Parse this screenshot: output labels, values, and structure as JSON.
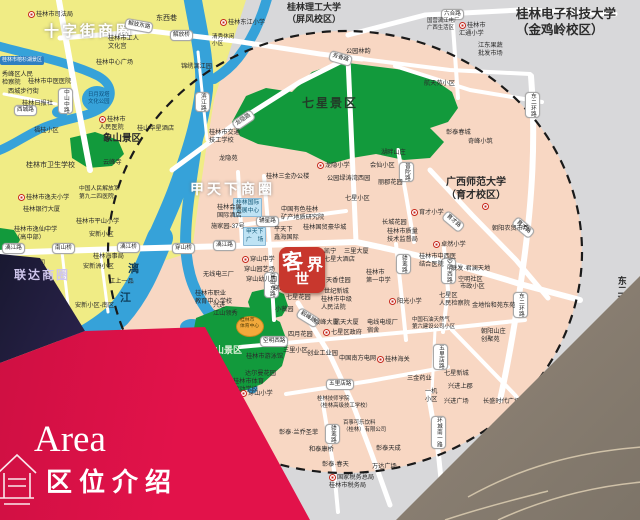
{
  "banner": {
    "area_en": "Area",
    "area_zh": "区位介绍"
  },
  "logo": {
    "c1": "客",
    "c2": "世",
    "c3": "界"
  },
  "photo_overlay_text": "联达商圈",
  "colors": {
    "background_gray": "#d8d8da",
    "district_salmon": "#f8d7c3",
    "downtown_yellow": "#f0ec85",
    "park_green": "#129a3c",
    "river_blue": "#36a2d9",
    "road_white": "#ffffff",
    "banner_red": "#e2124a",
    "logo_red": "#c8372d",
    "dashed_ring": "#1a1a1a"
  },
  "map": {
    "labels": [
      {
        "t": "十字街商圈",
        "x": 44,
        "y": 22,
        "k": "big",
        "fs": 15
      },
      {
        "t": "甲天下商圈",
        "x": 190,
        "y": 180,
        "k": "big",
        "fs": 14
      },
      {
        "t": "七星景区",
        "x": 302,
        "y": 96,
        "fs": 12,
        "b": 1,
        "c": "#223b28",
        "ls": 2
      },
      {
        "t": "穿山景区",
        "x": 206,
        "y": 345,
        "fs": 9,
        "b": 1,
        "c": "#dff0da"
      },
      {
        "t": "象山景区",
        "x": 103,
        "y": 133,
        "fs": 9.5,
        "b": 1
      },
      {
        "t": "漓",
        "x": 128,
        "y": 262,
        "fs": 11,
        "b": 1,
        "c": "#0f3f5c"
      },
      {
        "t": "江",
        "x": 120,
        "y": 291,
        "fs": 11,
        "b": 1,
        "c": "#0f3f5c"
      },
      {
        "t": "桂林电子科技大学\n（金鸡岭校区）",
        "x": 516,
        "y": 6,
        "fs": 12.5,
        "b": 1
      },
      {
        "t": "桂林理工大学\n（屏风校区）",
        "x": 287,
        "y": 2,
        "fs": 9,
        "b": 1
      },
      {
        "t": "广西师范大学\n（育才校区）",
        "x": 446,
        "y": 176,
        "fs": 10,
        "b": 1
      },
      {
        "t": "",
        "x": 482,
        "y": 203,
        "m": 1
      },
      {
        "t": "东二环路",
        "x": 615,
        "y": 276,
        "fs": 9,
        "b": 1,
        "v": 1
      },
      {
        "t": "解放东路",
        "x": 126,
        "y": 18,
        "k": "pill",
        "r": 10
      },
      {
        "t": "解放桥",
        "x": 170,
        "y": 30,
        "k": "pill"
      },
      {
        "t": "六合路",
        "x": 441,
        "y": 9,
        "k": "pill"
      },
      {
        "t": "芳香路",
        "x": 331,
        "y": 50,
        "k": "pill",
        "r": 16
      },
      {
        "t": "龙隐路",
        "x": 231,
        "y": 122,
        "k": "pill",
        "r": -34
      },
      {
        "t": "滨江路",
        "x": 195,
        "y": 92,
        "k": "pill",
        "v": 1
      },
      {
        "t": "中山中路",
        "x": 58,
        "y": 88,
        "k": "pill",
        "v": 1
      },
      {
        "t": "西城路",
        "x": 14,
        "y": 105,
        "k": "pill"
      },
      {
        "t": "漓江路",
        "x": 2,
        "y": 243,
        "k": "pill"
      },
      {
        "t": "南山桥",
        "x": 52,
        "y": 243,
        "k": "pill"
      },
      {
        "t": "漓江桥",
        "x": 117,
        "y": 242,
        "k": "pill"
      },
      {
        "t": "穿山桥",
        "x": 172,
        "y": 243,
        "k": "pill"
      },
      {
        "t": "漓江路",
        "x": 213,
        "y": 240,
        "k": "pill"
      },
      {
        "t": "穿山东路",
        "x": 264,
        "y": 272,
        "k": "pill",
        "v": 1
      },
      {
        "t": "辅星路",
        "x": 256,
        "y": 216,
        "k": "pill"
      },
      {
        "t": "普陀路",
        "x": 399,
        "y": 162,
        "k": "pill",
        "v": 1
      },
      {
        "t": "育才路",
        "x": 448,
        "y": 210,
        "k": "pill",
        "r": 40
      },
      {
        "t": "育才路",
        "x": 518,
        "y": 216,
        "k": "pill",
        "r": 40
      },
      {
        "t": "骖鸾路",
        "x": 396,
        "y": 254,
        "k": "pill",
        "v": 1
      },
      {
        "t": "毅峰路",
        "x": 301,
        "y": 307,
        "k": "pill",
        "r": 32
      },
      {
        "t": "空明西路",
        "x": 260,
        "y": 336,
        "k": "pill"
      },
      {
        "t": "空明西路",
        "x": 441,
        "y": 258,
        "k": "pill",
        "v": 1
      },
      {
        "t": "五里店路",
        "x": 326,
        "y": 379,
        "k": "pill"
      },
      {
        "t": "五里店路",
        "x": 433,
        "y": 344,
        "k": "pill",
        "v": 1
      },
      {
        "t": "骖鸾路",
        "x": 325,
        "y": 424,
        "k": "pill",
        "v": 1
      },
      {
        "t": "环城南一路",
        "x": 431,
        "y": 416,
        "k": "pill",
        "v": 1
      },
      {
        "t": "东二环路",
        "x": 525,
        "y": 92,
        "k": "pill",
        "v": 1
      },
      {
        "t": "东二环路",
        "x": 513,
        "y": 292,
        "k": "pill",
        "v": 1
      },
      {
        "t": "湖塘路",
        "x": 550,
        "y": 405,
        "k": "pill",
        "v": 1
      },
      {
        "t": "桂林国际\n会展中心",
        "x": 233,
        "y": 198,
        "k": "blue"
      },
      {
        "t": "甲天下\n广　场",
        "x": 243,
        "y": 227,
        "k": "blue"
      },
      {
        "t": "桂林市榕杉湖景区",
        "x": 0,
        "y": 56,
        "k": "blue2"
      },
      {
        "t": "桂林市司法局",
        "x": 28,
        "y": 11,
        "m": 1
      },
      {
        "t": "东西巷",
        "x": 156,
        "y": 14,
        "fs": 7
      },
      {
        "t": "桂林市工人\n文化宫",
        "x": 108,
        "y": 35
      },
      {
        "t": "桂林中心广场",
        "x": 96,
        "y": 59
      },
      {
        "t": "秀峰区人民\n检察院",
        "x": 2,
        "y": 71
      },
      {
        "t": "桂林市中医医院",
        "x": 28,
        "y": 78
      },
      {
        "t": "西城步行街",
        "x": 8,
        "y": 88
      },
      {
        "t": "桂林日报社",
        "x": 22,
        "y": 100
      },
      {
        "t": "日月双塔\n文化公园",
        "x": 88,
        "y": 92,
        "fs": 5.4,
        "c": "#0d4d7a"
      },
      {
        "t": "桂林市\n人民医院",
        "x": 99,
        "y": 116,
        "m": 1
      },
      {
        "t": "桂林市卫生学校",
        "x": 26,
        "y": 161,
        "fs": 7
      },
      {
        "t": "云峰寺",
        "x": 103,
        "y": 159
      },
      {
        "t": "福桂小区",
        "x": 34,
        "y": 127
      },
      {
        "t": "桂林市逸夫小学",
        "x": 18,
        "y": 194,
        "m": 1
      },
      {
        "t": "桂林银行大厦",
        "x": 23,
        "y": 206
      },
      {
        "t": "桂林市逸仙中学\n（高中部）",
        "x": 14,
        "y": 226
      },
      {
        "t": "中国人民解放军\n第九二四医院",
        "x": 79,
        "y": 186,
        "fs": 5.8
      },
      {
        "t": "桂林市平山小学",
        "x": 76,
        "y": 218
      },
      {
        "t": "安新小区",
        "x": 89,
        "y": 231
      },
      {
        "t": "桂林海事局",
        "x": 93,
        "y": 253
      },
      {
        "t": "安新洲小区",
        "x": 83,
        "y": 263
      },
      {
        "t": "江上一品",
        "x": 109,
        "y": 278
      },
      {
        "t": "安新小区-南区",
        "x": 75,
        "y": 302
      },
      {
        "t": "桂林三花股份公司",
        "x": 2,
        "y": 260,
        "fs": 5.4
      },
      {
        "t": "桂林东江小学",
        "x": 220,
        "y": 19,
        "m": 1
      },
      {
        "t": "清秀休闲\n小区",
        "x": 212,
        "y": 34,
        "fs": 5.6
      },
      {
        "t": "锦绣漓江园",
        "x": 181,
        "y": 63
      },
      {
        "t": "国营漓江电厂\n广西生活区",
        "x": 427,
        "y": 18,
        "fs": 5.4
      },
      {
        "t": "桂林市\n汇通小学",
        "x": 459,
        "y": 22,
        "m": 1
      },
      {
        "t": "江东果蔬\n批发市场",
        "x": 478,
        "y": 42
      },
      {
        "t": "公园林韵",
        "x": 346,
        "y": 48
      },
      {
        "t": "航天苑小区",
        "x": 424,
        "y": 80
      },
      {
        "t": "桂林市交通\n技工学校",
        "x": 209,
        "y": 129
      },
      {
        "t": "桂山华星酒店",
        "x": 137,
        "y": 125
      },
      {
        "t": "龙隐苑",
        "x": 219,
        "y": 155
      },
      {
        "t": "龙隐小学",
        "x": 317,
        "y": 162,
        "m": 1
      },
      {
        "t": "桂林三金办公楼",
        "x": 266,
        "y": 173
      },
      {
        "t": "公园绿涛湾西园",
        "x": 327,
        "y": 175
      },
      {
        "t": "会仙小区",
        "x": 370,
        "y": 162
      },
      {
        "t": "湖畔山庄",
        "x": 381,
        "y": 149
      },
      {
        "t": "彰泰春城",
        "x": 446,
        "y": 129
      },
      {
        "t": "奇峰小筑",
        "x": 468,
        "y": 138
      },
      {
        "t": "丽郡花园",
        "x": 378,
        "y": 179
      },
      {
        "t": "七星小区",
        "x": 345,
        "y": 195
      },
      {
        "t": "育才小学",
        "x": 411,
        "y": 209,
        "m": 1
      },
      {
        "t": "长城花园",
        "x": 382,
        "y": 219
      },
      {
        "t": "桂林国贸豪华城",
        "x": 303,
        "y": 224
      },
      {
        "t": "中国有色桂林\n矿产地质研究院",
        "x": 281,
        "y": 206
      },
      {
        "t": "平天下\n鑫海国际",
        "x": 274,
        "y": 226
      },
      {
        "t": "桂林会展\n国际酒店",
        "x": 217,
        "y": 204
      },
      {
        "t": "施家园-37号",
        "x": 211,
        "y": 223
      },
      {
        "t": "穿山中学",
        "x": 242,
        "y": 256,
        "m": 1
      },
      {
        "t": "穿山园艺场",
        "x": 244,
        "y": 266
      },
      {
        "t": "穿山幼儿园",
        "x": 246,
        "y": 276
      },
      {
        "t": "无线电三厂",
        "x": 203,
        "y": 271
      },
      {
        "t": "桂林市职业\n教育中心学校",
        "x": 195,
        "y": 290
      },
      {
        "t": "兴进\n江山领秀",
        "x": 213,
        "y": 302
      },
      {
        "t": "穿山东社区",
        "x": 273,
        "y": 285
      },
      {
        "t": "七星花园",
        "x": 286,
        "y": 294
      },
      {
        "t": "小薇园",
        "x": 275,
        "y": 306
      },
      {
        "t": "凯宁\n七星大酒店",
        "x": 324,
        "y": 248
      },
      {
        "t": "天香佳园",
        "x": 326,
        "y": 277
      },
      {
        "t": "世纪新城",
        "x": 324,
        "y": 288
      },
      {
        "t": "桂林市中级\n人民法院",
        "x": 321,
        "y": 296
      },
      {
        "t": "三里大厦",
        "x": 344,
        "y": 248
      },
      {
        "t": "桂林市\n第一中学",
        "x": 366,
        "y": 269
      },
      {
        "t": "阳光小学",
        "x": 389,
        "y": 298,
        "m": 1
      },
      {
        "t": "桂林市质量\n技术监督局",
        "x": 387,
        "y": 228
      },
      {
        "t": "卓然小学",
        "x": 433,
        "y": 241,
        "m": 1
      },
      {
        "t": "桂林市中西医\n结合医院",
        "x": 419,
        "y": 253
      },
      {
        "t": "朝阳农贸市场",
        "x": 492,
        "y": 225
      },
      {
        "t": "联发·君澜天地",
        "x": 451,
        "y": 265
      },
      {
        "t": "空明社区",
        "x": 458,
        "y": 276
      },
      {
        "t": "市政小区",
        "x": 460,
        "y": 283
      },
      {
        "t": "七星区\n人民检察院",
        "x": 439,
        "y": 292
      },
      {
        "t": "金地怡和苑东苑",
        "x": 472,
        "y": 302
      },
      {
        "t": "中国石油天然气\n第六建设公司小区",
        "x": 412,
        "y": 317,
        "fs": 5.4
      },
      {
        "t": "朝阳山庄\n创聚苑",
        "x": 481,
        "y": 328
      },
      {
        "t": "毅峰大厦",
        "x": 314,
        "y": 319
      },
      {
        "t": "航天大厦",
        "x": 334,
        "y": 319
      },
      {
        "t": "电线电缆厂\n宿舍",
        "x": 367,
        "y": 319
      },
      {
        "t": "七星区政府",
        "x": 323,
        "y": 329,
        "m": 1
      },
      {
        "t": "四月花园",
        "x": 288,
        "y": 331
      },
      {
        "t": "三里小区",
        "x": 283,
        "y": 347
      },
      {
        "t": "创业工业园",
        "x": 307,
        "y": 350
      },
      {
        "t": "中国南方电网",
        "x": 339,
        "y": 355
      },
      {
        "t": "桂林海关",
        "x": 377,
        "y": 356,
        "m": 1
      },
      {
        "t": "桂林市\n体育中心",
        "x": 240,
        "y": 318,
        "fs": 4.8,
        "c": "#503a06"
      },
      {
        "t": "桂林市游泳馆",
        "x": 246,
        "y": 353
      },
      {
        "t": "达尔曼花园",
        "x": 245,
        "y": 370
      },
      {
        "t": "桂林市体育\n运动学校",
        "x": 233,
        "y": 378
      },
      {
        "t": "穿山小学",
        "x": 240,
        "y": 390,
        "m": 1
      },
      {
        "t": "桂林技师学院\n（桂林高级技工学校）",
        "x": 317,
        "y": 396,
        "fs": 5.4
      },
      {
        "t": "百事可乐饮料\n（桂林）有限公司",
        "x": 343,
        "y": 420,
        "fs": 5.4
      },
      {
        "t": "彰泰·兰乔圣菲",
        "x": 279,
        "y": 429
      },
      {
        "t": "和泰康桥",
        "x": 309,
        "y": 446
      },
      {
        "t": "彰泰·春天",
        "x": 322,
        "y": 461
      },
      {
        "t": "彰泰天成",
        "x": 376,
        "y": 445
      },
      {
        "t": "万达广场",
        "x": 372,
        "y": 463
      },
      {
        "t": "国家税务总局\n桂林市税务局",
        "x": 329,
        "y": 474,
        "m": 1
      },
      {
        "t": "七星新城",
        "x": 444,
        "y": 370
      },
      {
        "t": "三金药业",
        "x": 407,
        "y": 375
      },
      {
        "t": "兴进上郡",
        "x": 448,
        "y": 383
      },
      {
        "t": "一机\n小区",
        "x": 425,
        "y": 388
      },
      {
        "t": "兴进广场",
        "x": 444,
        "y": 398
      },
      {
        "t": "长盛时代广场",
        "x": 483,
        "y": 398
      },
      {
        "t": "桂林任远中学",
        "x": 507,
        "y": 425,
        "m": 1
      }
    ]
  }
}
